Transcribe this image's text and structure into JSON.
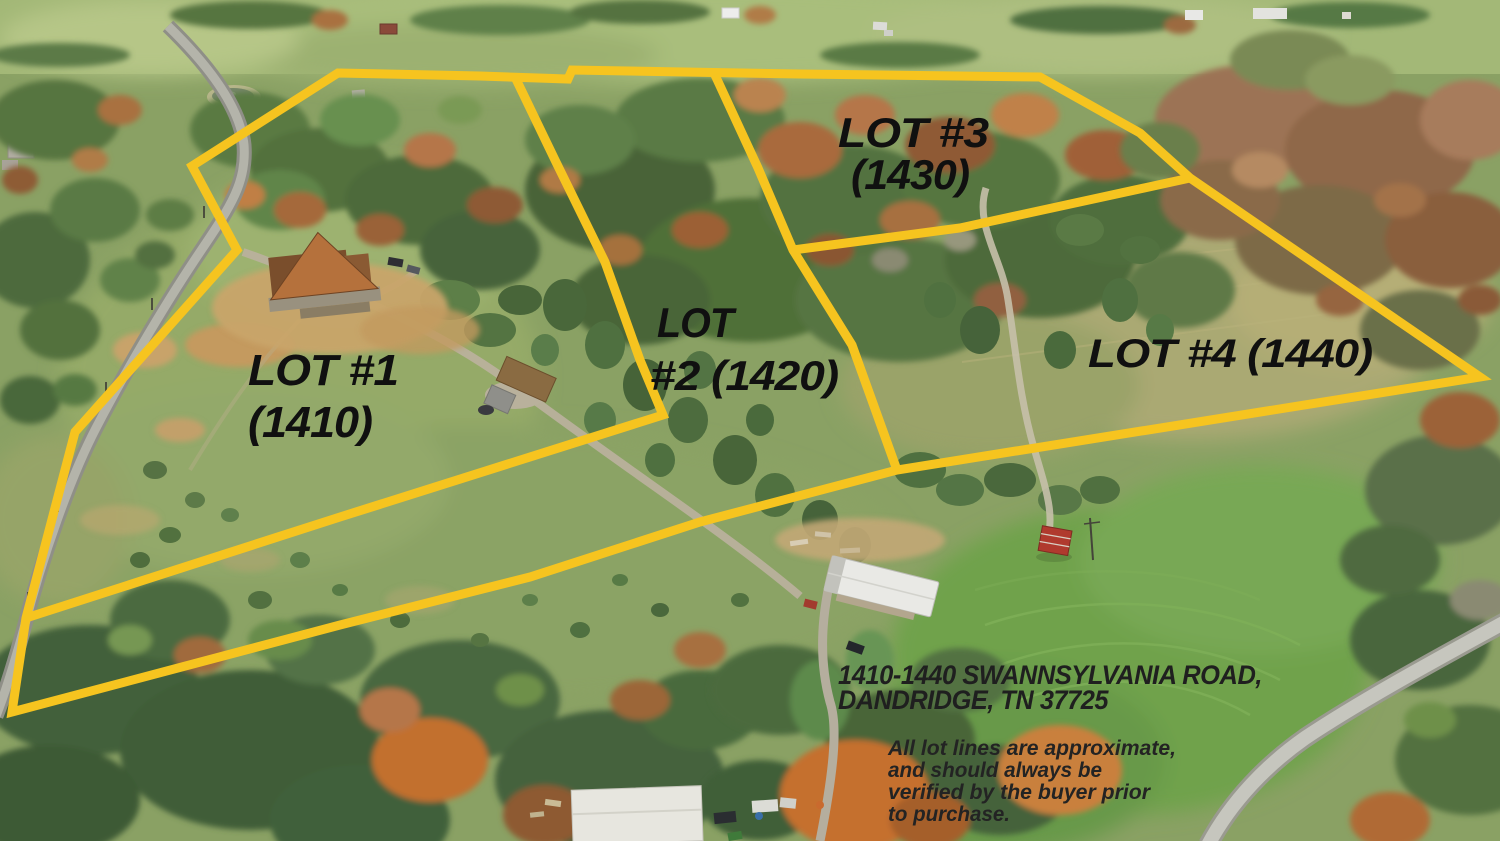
{
  "type": "aerial-lot-boundary-photo",
  "colors": {
    "boundary": "#f6c41f",
    "lot_label": "#101010",
    "address_text": "#1f1f1f",
    "disclaimer_text": "#232323"
  },
  "lots": [
    {
      "id": "1",
      "address_number": "1410",
      "label_line1": "LOT #1",
      "label_line2": "(1410)"
    },
    {
      "id": "2",
      "address_number": "1420",
      "label_line1": "LOT",
      "label_line2": "#2 (1420)"
    },
    {
      "id": "3",
      "address_number": "1430",
      "label_line1": "LOT #3",
      "label_line2": "(1430)"
    },
    {
      "id": "4",
      "address_number": "1440",
      "label_line1": "LOT #4 (1440)",
      "label_line2": ""
    }
  ],
  "address": {
    "line1": "1410-1440 SWANNSYLVANIA ROAD,",
    "line2": "DANDRIDGE, TN 37725"
  },
  "disclaimer": {
    "line1": "All lot lines are approximate,",
    "line2": "and should always be",
    "line3": "verified by the buyer prior",
    "line4": "to purchase."
  }
}
